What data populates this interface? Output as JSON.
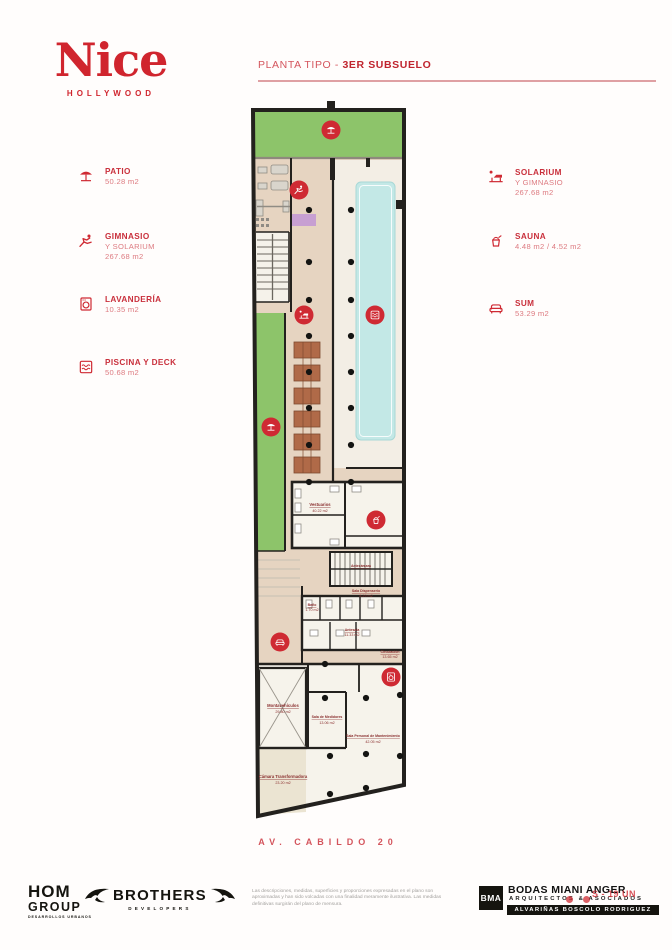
{
  "colors": {
    "accent_red": "#cf2a33",
    "patio_green": "#8dc46a",
    "floor_beige": "#e6d4c1",
    "pool_water": "#c3e8e6",
    "wall_black": "#23211e"
  },
  "logo": {
    "name": "Nice",
    "sub": "HOLLYWOOD"
  },
  "header": {
    "title_prefix": "PLANTA TIPO - ",
    "title_bold": "3ER SUBSUELO"
  },
  "legend_left": [
    {
      "icon": "patio-icon",
      "label": "PATIO",
      "line1": "50.28 m2",
      "line2": ""
    },
    {
      "icon": "gym-icon",
      "label": "GIMNASIO",
      "line1": "Y SOLARIUM",
      "line2": "267.68 m2"
    },
    {
      "icon": "laundry-icon",
      "label": "LAVANDERÍA",
      "line1": "10.35 m2",
      "line2": ""
    },
    {
      "icon": "pool-icon",
      "label": "PISCINA Y DECK",
      "line1": "50.68 m2",
      "line2": ""
    }
  ],
  "legend_right": [
    {
      "icon": "solarium-icon",
      "label": "SOLARIUM",
      "line1": "Y GIMNASIO",
      "line2": "267.68 m2"
    },
    {
      "icon": "sauna-icon",
      "label": "SAUNA",
      "line1": "4.48 m2 / 4.52 m2",
      "line2": ""
    },
    {
      "icon": "sum-icon",
      "label": "SUM",
      "line1": "53.29 m2",
      "line2": ""
    }
  ],
  "plan": {
    "address": "AV. CABILDO 20",
    "rooms": [
      {
        "name": "Vestuarios",
        "area": "40.22 m2"
      },
      {
        "name": "Antecámara",
        "area": ""
      },
      {
        "name": "Sala Dispenserio",
        "area": "8.29 m2"
      },
      {
        "name": "Baño",
        "area": "1.70 m2"
      },
      {
        "name": "Antesala",
        "area": "11.33 m2"
      },
      {
        "name": "Circulación",
        "area": "13.65 m2"
      },
      {
        "name": "Montavehículos",
        "area": "29.80 m2"
      },
      {
        "name": "Sala de Medidores",
        "area": "13.06 m2"
      },
      {
        "name": "Sala Personal de Mantenimiento",
        "area": "42.05 m2"
      },
      {
        "name": "Cámara Transformadora",
        "area": "23.20 m2"
      }
    ]
  },
  "footer": {
    "hom": {
      "line1": "HOM",
      "line2": "GROUP",
      "tagline": "DESARROLLOS URBANOS"
    },
    "brothers": {
      "name": "BROTHERS",
      "sub": "DEVELOPERS"
    },
    "disclaimer": [
      "Las descripciones, medidas, superficies y proporciones expresadas en el plano son",
      "aproximadas y han sido volcadas con una finalidad meramente ilustrativa. Las medidas",
      "definitivas surgirán del plano de mensura."
    ],
    "bma": {
      "logo": "BMA",
      "line1": "BODAS MIANI ANGER",
      "line2": "ARQUITECTOS & ASOCIADOS",
      "line3": "ALVARIÑAS BOSCOLO RODRIGUEZ",
      "overlay": "S - 19 UN"
    }
  }
}
